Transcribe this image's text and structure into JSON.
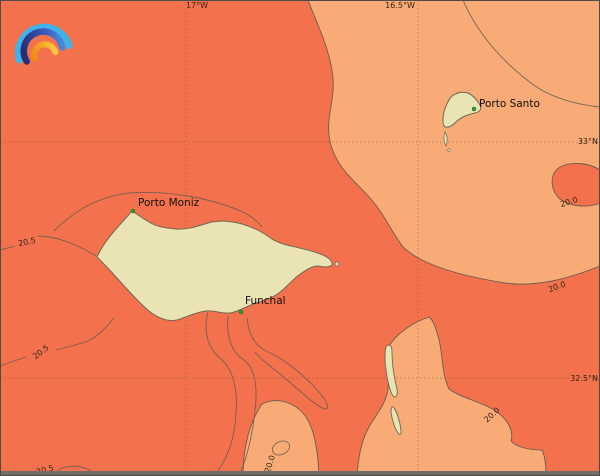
{
  "map": {
    "title": "Sea surface temperature isotherm map - Madeira archipelago",
    "colors": {
      "sea_warm": "#F4714D",
      "sea_cool": "#F8AB76",
      "land": "#EAE3B4",
      "coastline": "#6F6854",
      "contour": "#6A5D4F",
      "grid": "#8A5A3A",
      "city_marker": "#2CA02C",
      "frame": "#4C4B47"
    },
    "grid": {
      "meridians": [
        {
          "label": "17°W"
        },
        {
          "label": "16.5°W"
        }
      ],
      "parallels": [
        {
          "label": "33°N"
        },
        {
          "label": "32.5°N"
        }
      ]
    },
    "places": [
      {
        "name": "Porto Moniz"
      },
      {
        "name": "Funchal"
      },
      {
        "name": "Porto Santo"
      }
    ],
    "contour_labels": [
      {
        "text": "20.5"
      },
      {
        "text": "20.5"
      },
      {
        "text": "20.5"
      },
      {
        "text": "20.0"
      },
      {
        "text": "20.0"
      },
      {
        "text": "20.0"
      },
      {
        "text": "20.0"
      }
    ],
    "logo": {
      "name": "rainbow-arcs-weather-logo"
    }
  }
}
